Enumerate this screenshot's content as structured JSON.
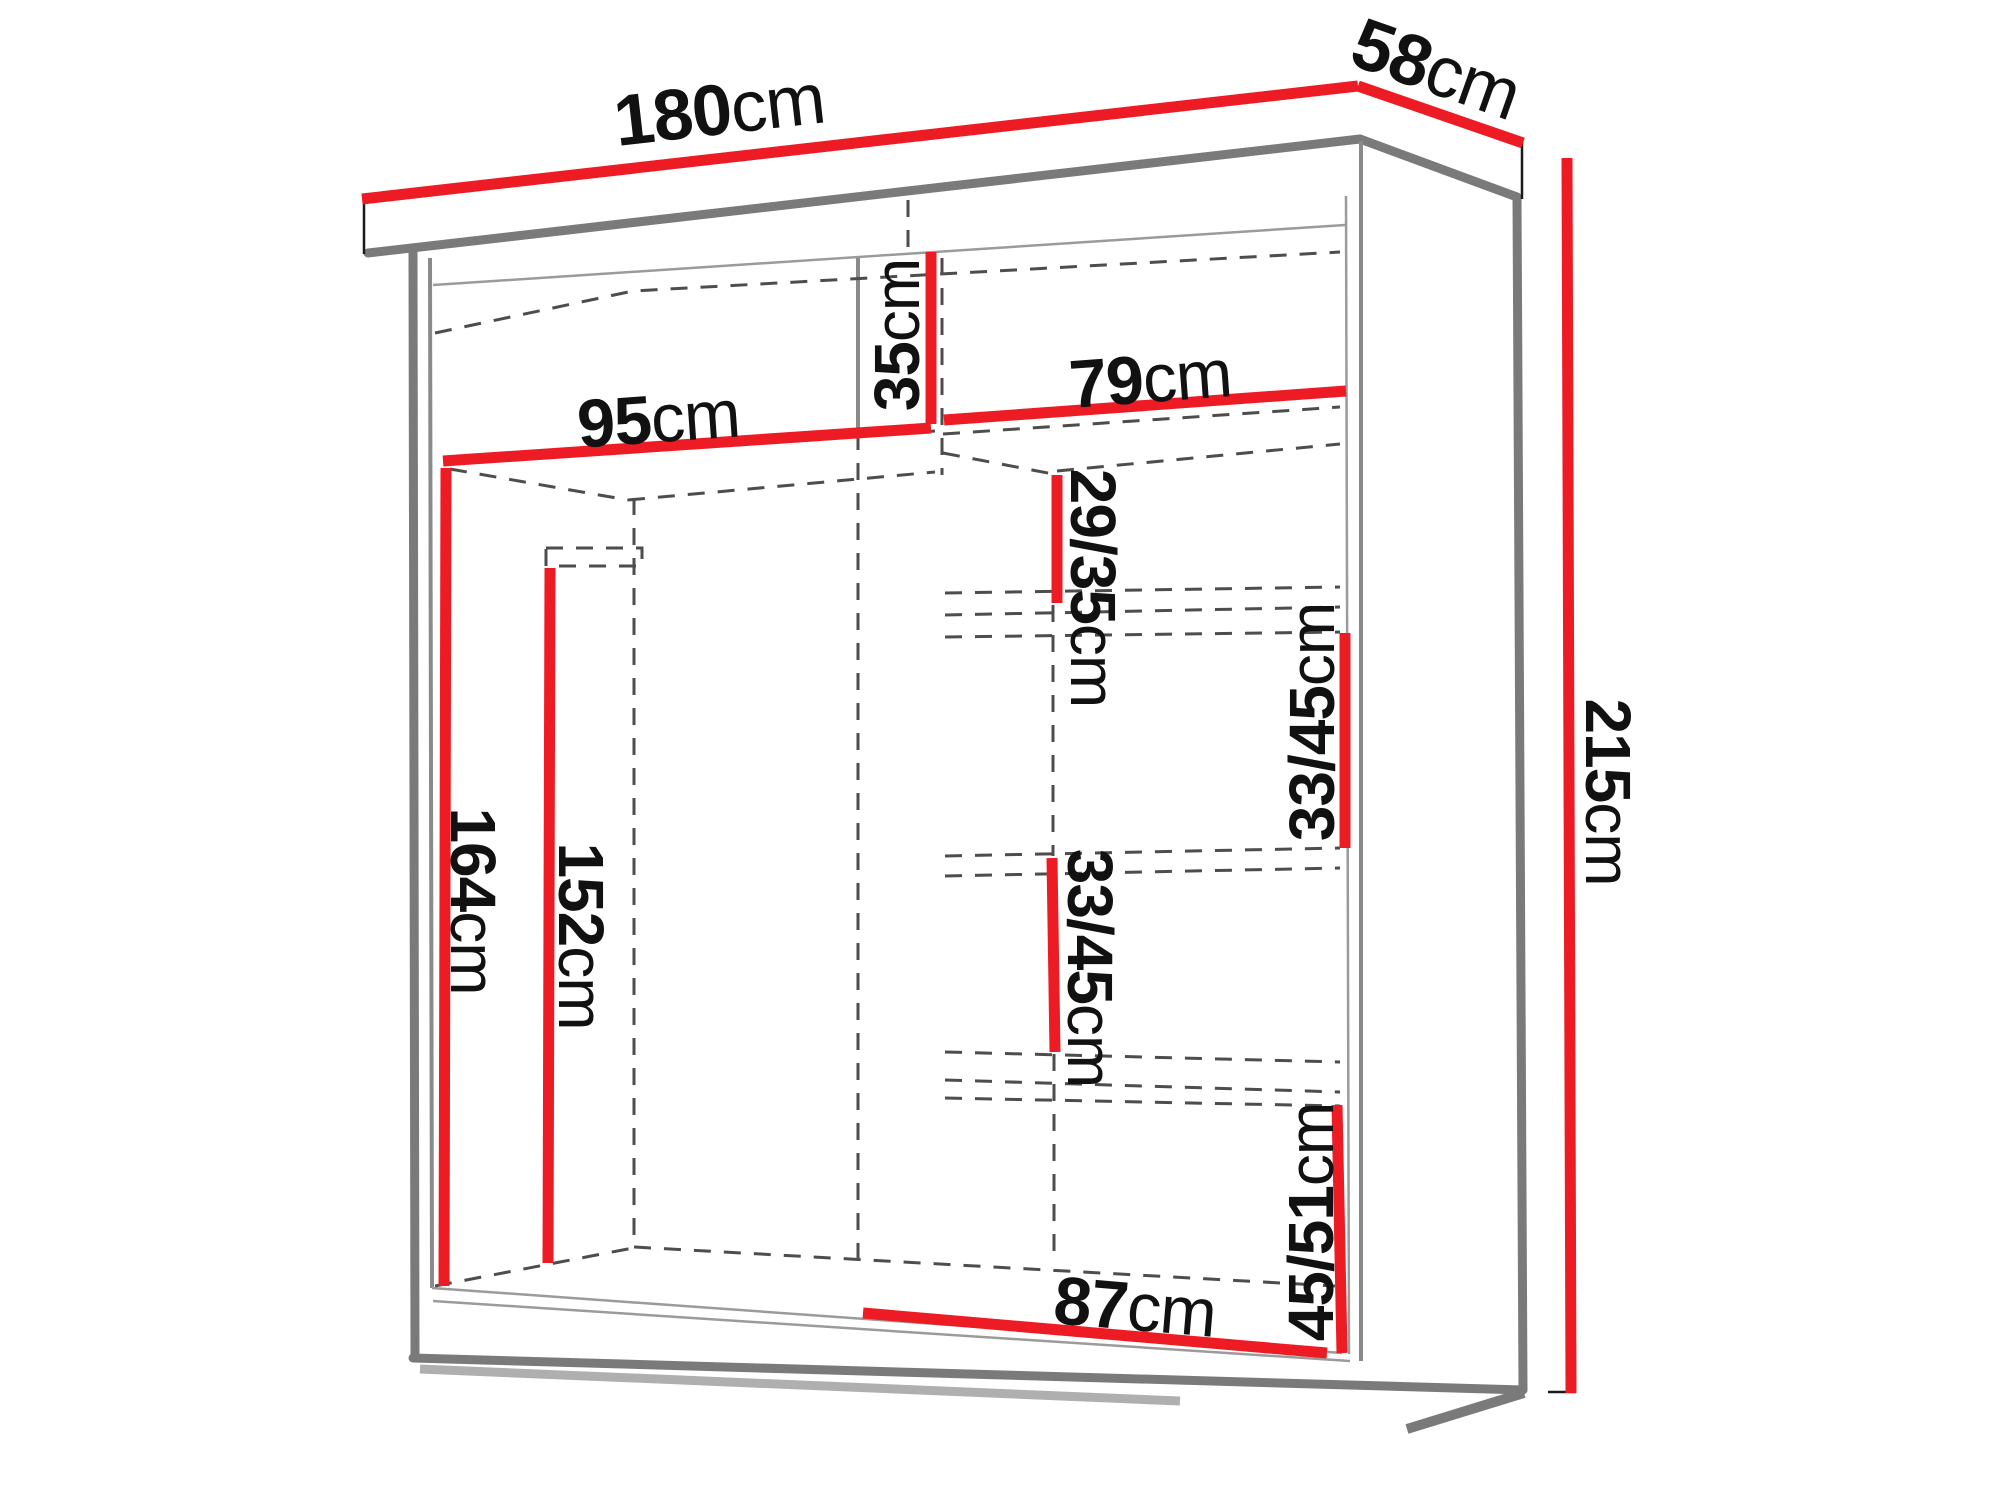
{
  "diagram": {
    "title": "wardrobe-dimension-diagram",
    "background_color": "#ffffff",
    "accent_color": "#ed1c24",
    "line_color": "#7a7a7a",
    "text_color": "#111111",
    "labels": {
      "d180": {
        "value": "180",
        "unit": "cm",
        "meaning": "total-width-top"
      },
      "d58": {
        "value": "58",
        "unit": "cm",
        "meaning": "depth-top"
      },
      "d215": {
        "value": "215",
        "unit": "cm",
        "meaning": "total-height-right"
      },
      "d95": {
        "value": "95",
        "unit": "cm",
        "meaning": "left-section-width"
      },
      "d35": {
        "value": "35",
        "unit": "cm",
        "meaning": "top-shelf-height"
      },
      "d79": {
        "value": "79",
        "unit": "cm",
        "meaning": "right-section-width"
      },
      "d2935": {
        "value": "29/35",
        "unit": "cm",
        "meaning": "upper-shelf-gap"
      },
      "d3345r": {
        "value": "33/45",
        "unit": "cm",
        "meaning": "right-shelf-gap"
      },
      "d3345c": {
        "value": "33/45",
        "unit": "cm",
        "meaning": "center-shelf-gap"
      },
      "d164": {
        "value": "164",
        "unit": "cm",
        "meaning": "left-interior-height"
      },
      "d152": {
        "value": "152",
        "unit": "cm",
        "meaning": "hanging-rail-height"
      },
      "d4551": {
        "value": "45/51",
        "unit": "cm",
        "meaning": "bottom-shelf-gap"
      },
      "d87": {
        "value": "87",
        "unit": "cm",
        "meaning": "bottom-section-width"
      }
    }
  }
}
